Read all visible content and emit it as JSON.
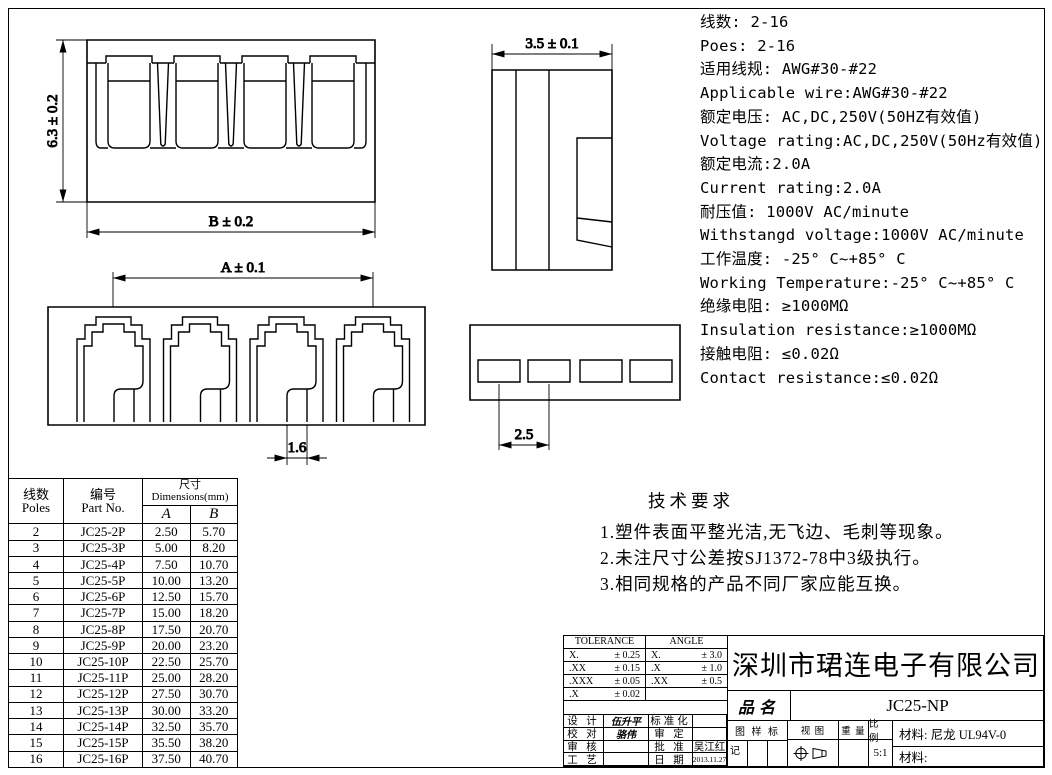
{
  "specs": {
    "lines": [
      "线数: 2-16",
      "Poes: 2-16",
      "适用线规: AWG#30-#22",
      "Applicable wire:AWG#30-#22",
      "额定电压: AC,DC,250V(50HZ有效值)",
      "Voltage rating:AC,DC,250V(50Hz有效值)",
      "额定电流:2.0A",
      "Current rating:2.0A",
      "耐压值: 1000V AC/minute",
      "Withstangd voltage:1000V AC/minute",
      "工作温度: -25° C~+85° C",
      "Working Temperature:-25° C~+85° C",
      "绝缘电阻: ≥1000MΩ",
      "Insulation resistance:≥1000MΩ",
      "接触电阻: ≤0.02Ω",
      "Contact resistance:≤0.02Ω"
    ]
  },
  "tech_requirements": {
    "title": "技术要求",
    "items": [
      "1.塑件表面平整光洁,无飞边、毛刺等现象。",
      "2.未注尺寸公差按SJ1372-78中3级执行。",
      "3.相同规格的产品不同厂家应能互换。"
    ]
  },
  "dimensions": {
    "front_height": "6.3 ± 0.2",
    "front_width": "B ± 0.2",
    "side_width": "3.5 ± 0.1",
    "top_span": "A ± 0.1",
    "slot_width": "1.6",
    "pitch": "2.5"
  },
  "parts_table": {
    "col1_zh": "线数",
    "col1_en": "Poles",
    "col2_zh": "编号",
    "col2_en": "Part No.",
    "dim_header": "尺寸Dimensions(mm)",
    "col_a": "A",
    "col_b": "B",
    "rows": [
      [
        "2",
        "JC25-2P",
        "2.50",
        "5.70"
      ],
      [
        "3",
        "JC25-3P",
        "5.00",
        "8.20"
      ],
      [
        "4",
        "JC25-4P",
        "7.50",
        "10.70"
      ],
      [
        "5",
        "JC25-5P",
        "10.00",
        "13.20"
      ],
      [
        "6",
        "JC25-6P",
        "12.50",
        "15.70"
      ],
      [
        "7",
        "JC25-7P",
        "15.00",
        "18.20"
      ],
      [
        "8",
        "JC25-8P",
        "17.50",
        "20.70"
      ],
      [
        "9",
        "JC25-9P",
        "20.00",
        "23.20"
      ],
      [
        "10",
        "JC25-10P",
        "22.50",
        "25.70"
      ],
      [
        "11",
        "JC25-11P",
        "25.00",
        "28.20"
      ],
      [
        "12",
        "JC25-12P",
        "27.50",
        "30.70"
      ],
      [
        "13",
        "JC25-13P",
        "30.00",
        "33.20"
      ],
      [
        "14",
        "JC25-14P",
        "32.50",
        "35.70"
      ],
      [
        "15",
        "JC25-15P",
        "35.50",
        "38.20"
      ],
      [
        "16",
        "JC25-16P",
        "37.50",
        "40.70"
      ]
    ]
  },
  "title_block": {
    "tolerance": {
      "header": "TOLERANCE",
      "rows": [
        [
          "X.",
          "± 0.25"
        ],
        [
          ".XX",
          "± 0.15"
        ],
        [
          ".XXX",
          "± 0.05"
        ],
        [
          ".X",
          "± 0.02"
        ]
      ]
    },
    "angle": {
      "header": "ANGLE",
      "rows": [
        [
          "X.",
          "± 3.0"
        ],
        [
          ".X",
          "± 1.0"
        ],
        [
          ".XX",
          "± 0.5"
        ],
        [
          "",
          ""
        ]
      ]
    },
    "signatures": [
      [
        "设 计",
        "伍升平",
        "标准化",
        ""
      ],
      [
        "校 对",
        "骆伟",
        "审 定",
        ""
      ],
      [
        "审 核",
        "",
        "批 准",
        "吴江红"
      ],
      [
        "工 艺",
        "",
        "日 期",
        "2013.11.27"
      ]
    ],
    "company": "深圳市珺连电子有限公司",
    "product_label": "品名",
    "product_name": "JC25-NP",
    "stamp_label": "图 样 标",
    "stamp_label2": "记",
    "view_label": "视 图",
    "weight_label": "重 量",
    "scale_label": "比 例",
    "scale_value": "5:1",
    "material1": "材料: 尼龙 UL94V-0",
    "material2": "材料:",
    "line_color": "#000000",
    "background_color": "#ffffff"
  }
}
